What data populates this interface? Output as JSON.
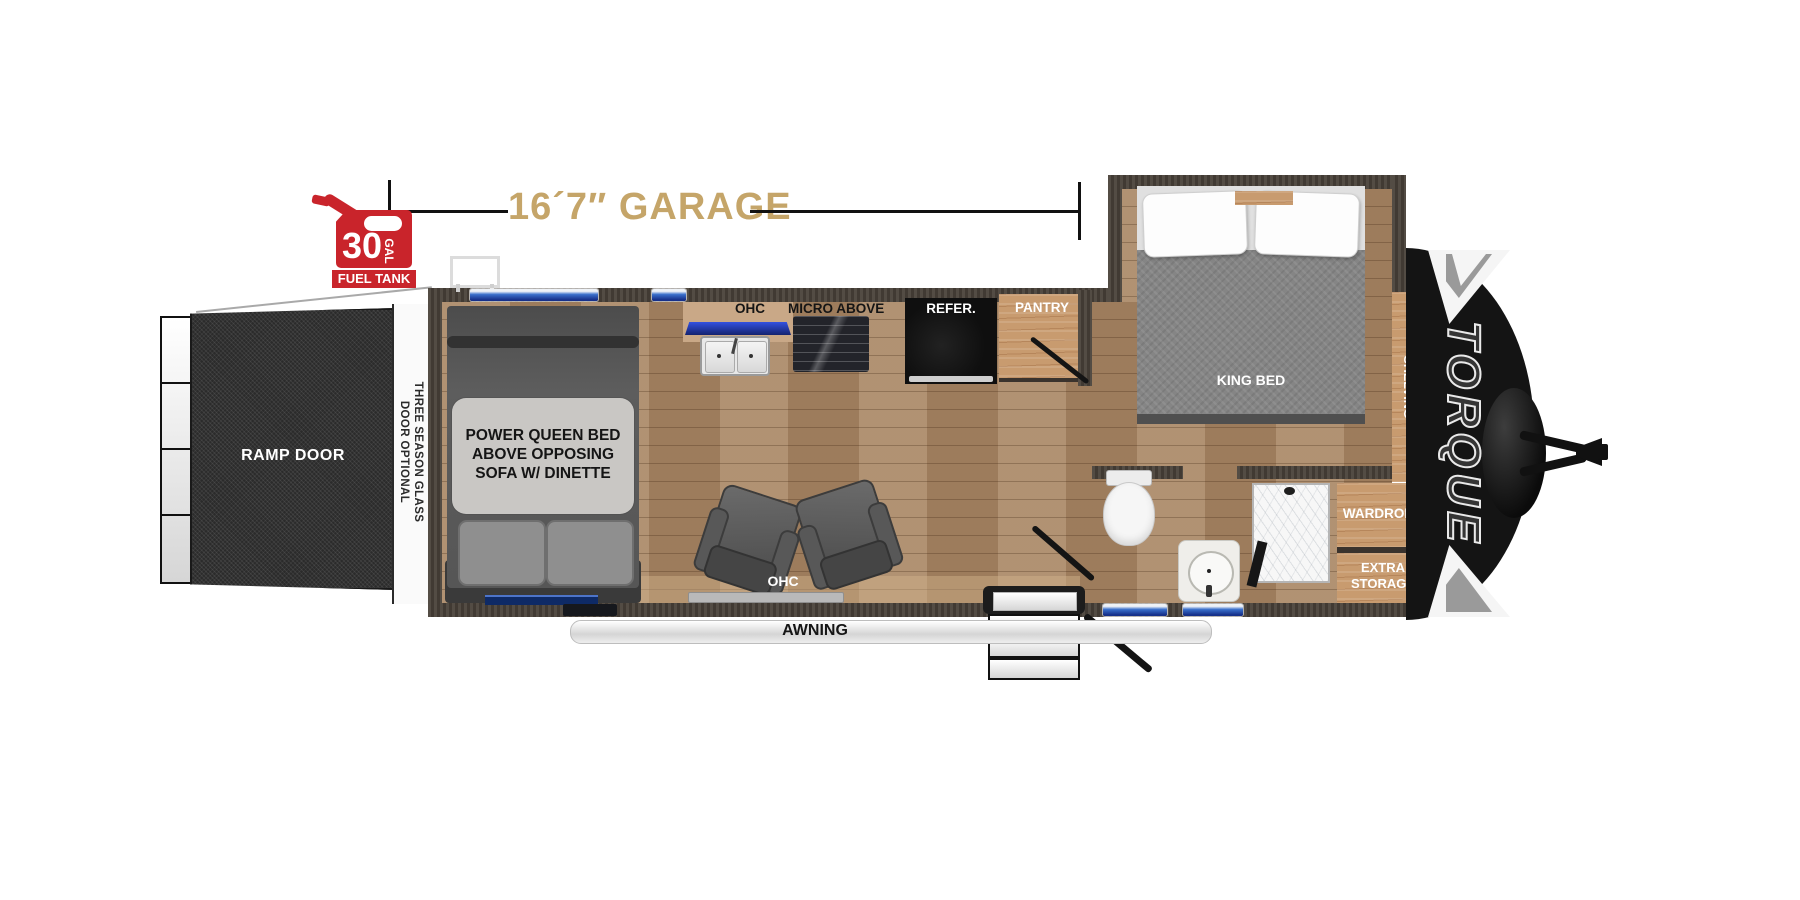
{
  "title": "Torque toy hauler floor plan",
  "colors": {
    "dimension_text": "#c5a569",
    "fuel_red": "#c9242b",
    "wall": "#4a423a",
    "floor_wood": "#ab8a68",
    "cabinet_wood": "#c89b6f",
    "window_blue": "#2f5fc4",
    "cap_black": "#141414"
  },
  "dimension": {
    "garage": "16´7″ GARAGE"
  },
  "fuel_tank": {
    "capacity": "30",
    "unit": "GAL",
    "name": "FUEL TANK"
  },
  "garage": {
    "ramp_door": "RAMP DOOR",
    "three_season_line1": "THREE SEASON GLASS",
    "three_season_line2": "DOOR OPTIONAL",
    "queen_bed_line1": "POWER QUEEN BED",
    "queen_bed_line2": "ABOVE OPPOSING",
    "queen_bed_line3": "SOFA W/ DINETTE",
    "ohc_top": "OHC",
    "ohc_bottom": "OHC"
  },
  "kitchen": {
    "micro": "MICRO ABOVE",
    "refrigerator": "REFER.",
    "pantry": "PANTRY"
  },
  "bedroom": {
    "king_bed": "KING BED",
    "cabinets_line1": "CABINETS W/",
    "cabinets_line2": "SHELVING",
    "wardrobe": "WARDROBE",
    "extra_line1": "EXTRA",
    "extra_line2": "STORAGE"
  },
  "exterior": {
    "awning": "AWNING",
    "brand": "TORQUE"
  }
}
